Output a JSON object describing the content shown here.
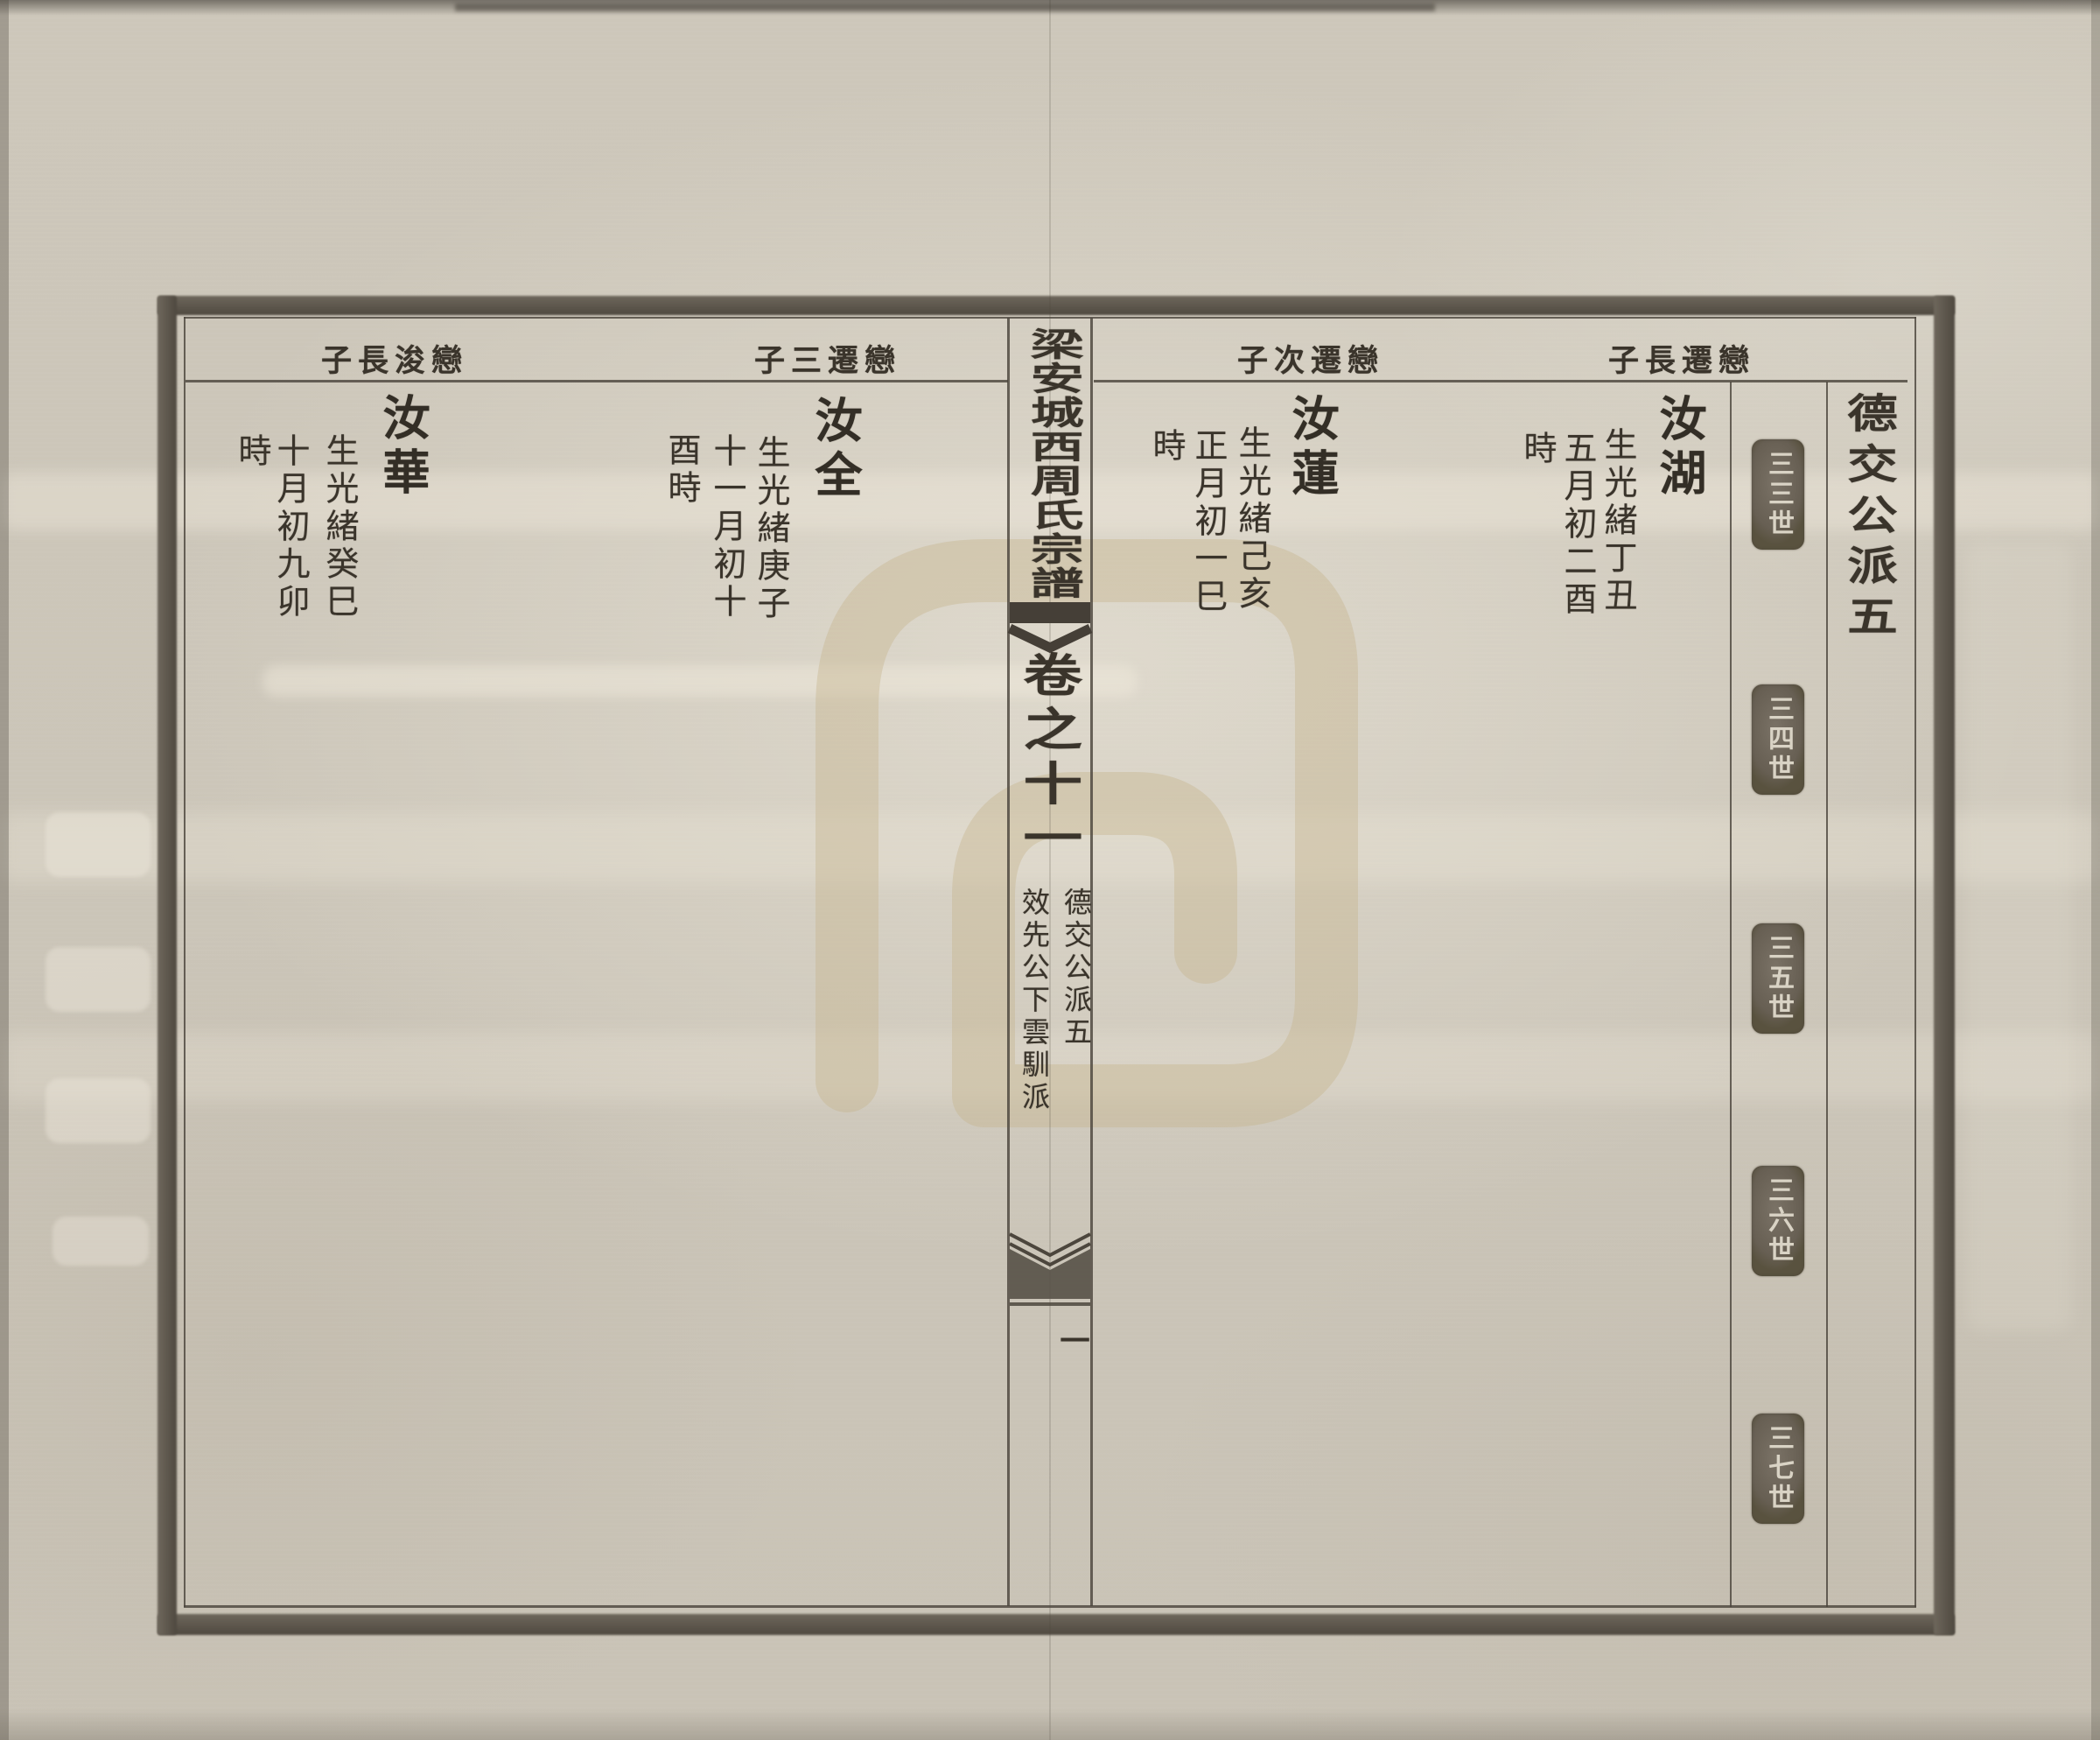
{
  "document": {
    "type": "genealogy-scan",
    "spine": {
      "title": "梁安城西周氏宗譜",
      "volume": "卷之十一",
      "branch_right": "德交公派五",
      "branch_left": "效先公下雲馴派",
      "leaf_number": "一"
    },
    "right_page": {
      "margin_title": "德交公派五",
      "generation_stamps": [
        "三三世",
        "三四世",
        "三五世",
        "三六世",
        "三七世"
      ],
      "entries": [
        {
          "header_display": "子長遷戀",
          "header_reading": "戀遷長子",
          "name": "汝湖",
          "birth_cols": [
            "生光緒丁丑",
            "五月初二酉",
            "時"
          ]
        },
        {
          "header_display": "子次遷戀",
          "header_reading": "戀遷次子",
          "name": "汝蓮",
          "birth_cols": [
            "生光緒己亥",
            "正月初一巳",
            "時"
          ]
        }
      ]
    },
    "left_page": {
      "entries": [
        {
          "header_display": "子三遷戀",
          "header_reading": "戀遷三子",
          "name": "汝全",
          "birth_cols": [
            "生光緒庚子",
            "十一月初十",
            "酉時"
          ]
        },
        {
          "header_display": "子長浚戀",
          "header_reading": "戀浚長子",
          "name": "汝華",
          "birth_cols": [
            "生光緒癸巳",
            "十月初九卯",
            "時"
          ]
        }
      ]
    },
    "colors": {
      "paper": "#cdc7ba",
      "ink": "#3a342b",
      "frame": "#5f584d",
      "stamp_background": "#675f53",
      "stamp_text": "#d9d3c5",
      "watermark": "#c6b38c"
    }
  }
}
